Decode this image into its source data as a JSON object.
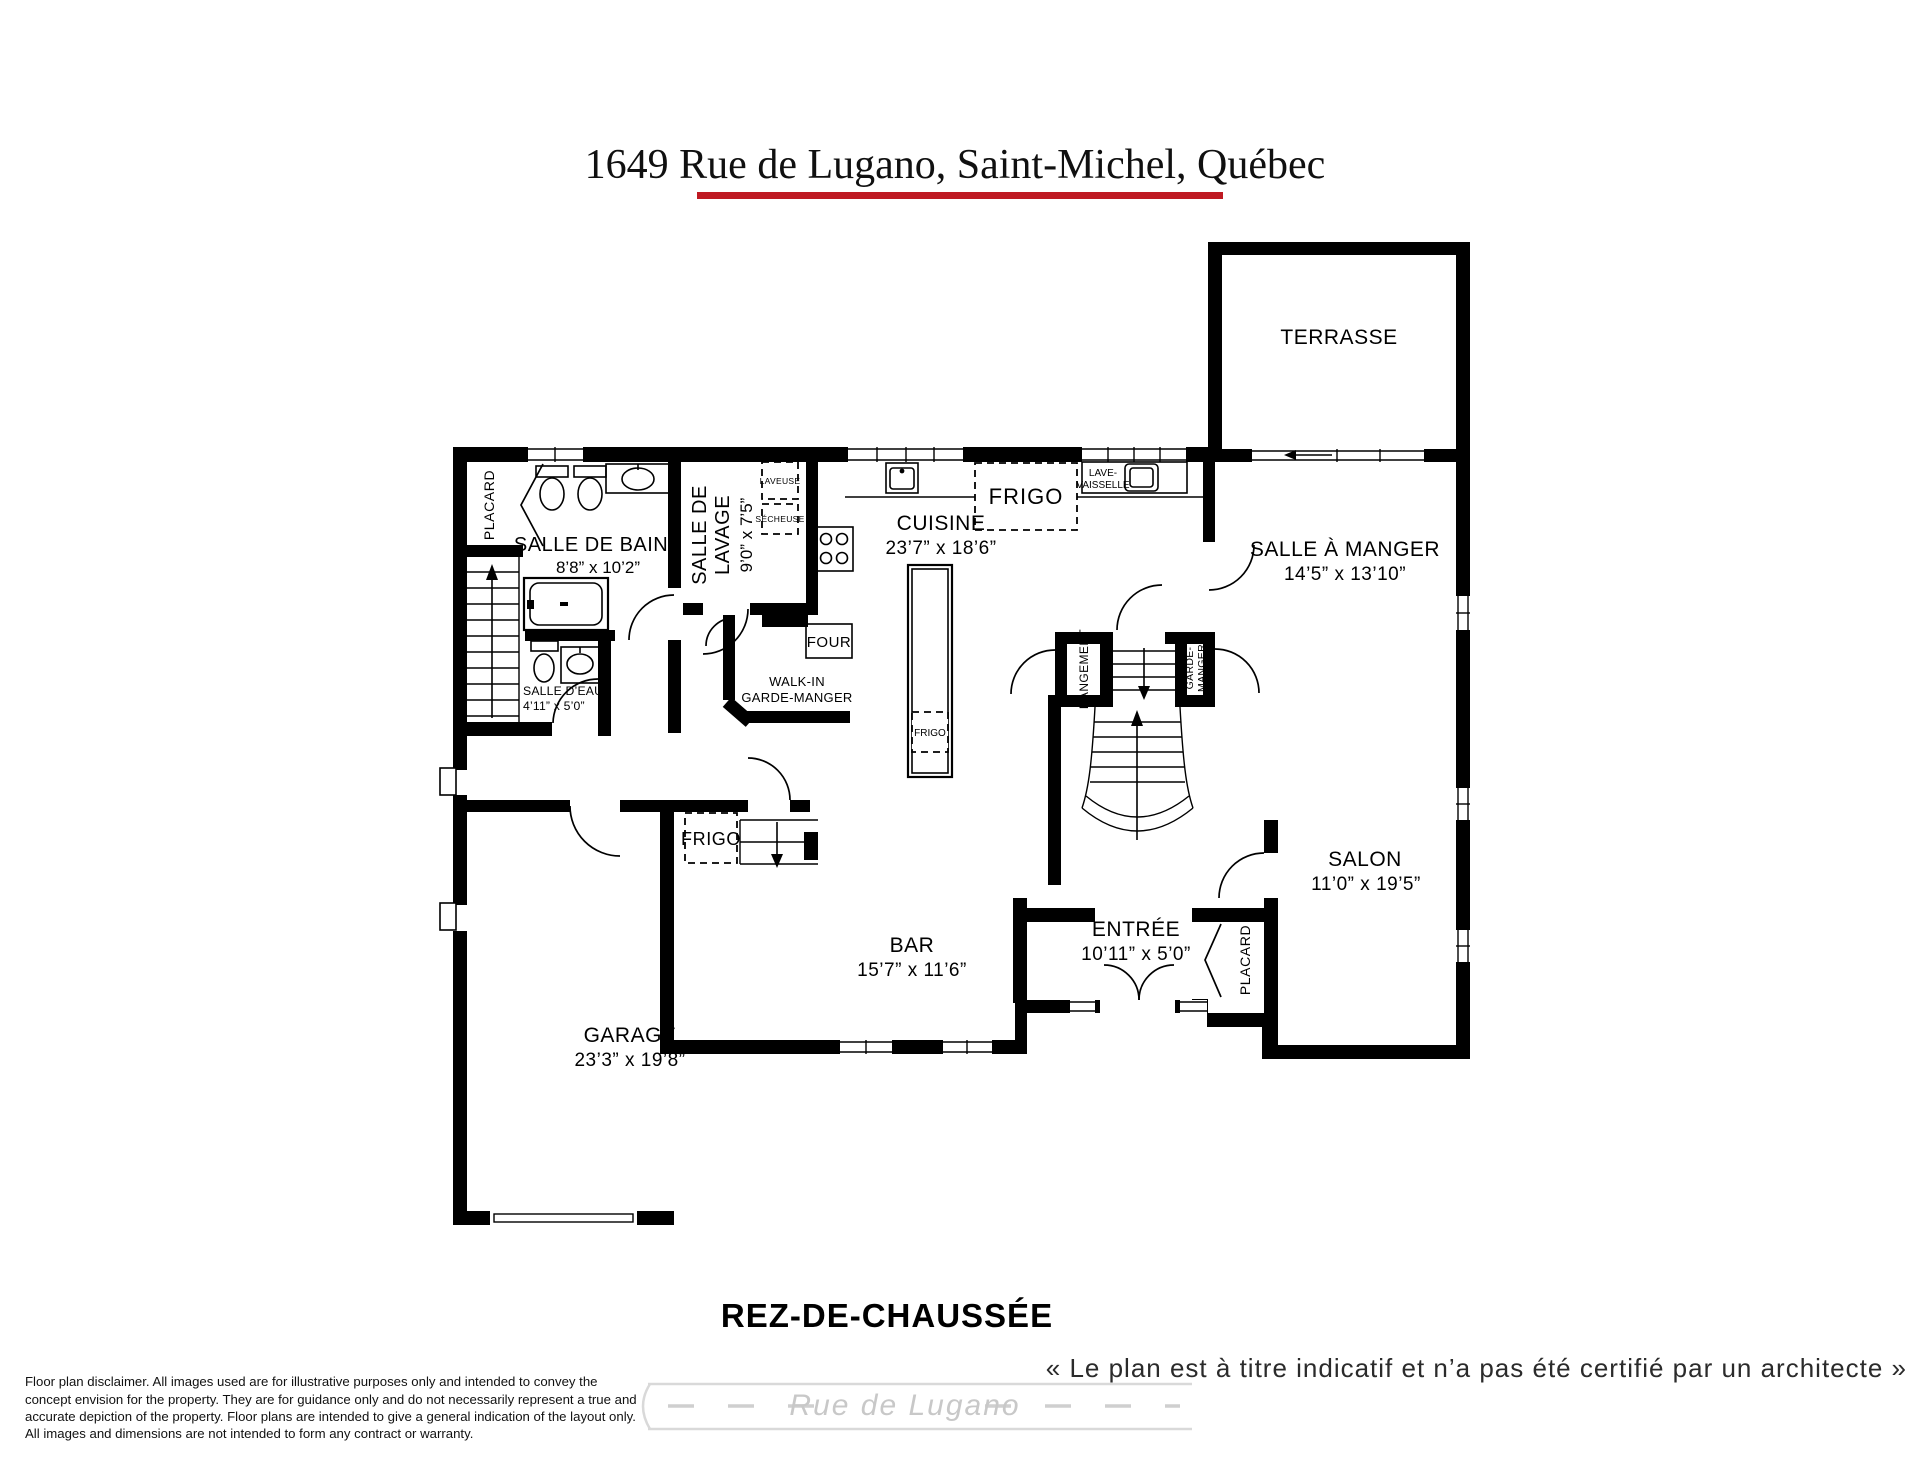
{
  "page": {
    "title": "1649 Rue de Lugano, Saint-Michel, Québec",
    "underline_color": "#bf1a22",
    "floor_label": "REZ-DE-CHAUSSÉE",
    "quote": "« Le plan est à titre indicatif et n’a pas été certifié par un architecte »",
    "street_watermark": "Rue de Lugano"
  },
  "disclaimer": {
    "lines": [
      "Floor plan disclaimer. All images used are for illustrative purposes only and intended to convey the",
      "concept envision for the property. They are for guidance only and do not necessarily represent a true and",
      "accurate depiction of the property. Floor plans are intended to give a general indication of the layout only.",
      "All images and dimensions are not intended to form any contract or warranty."
    ]
  },
  "rooms": {
    "terrasse": {
      "name": "TERRASSE"
    },
    "salle_de_bains": {
      "name": "SALLE DE BAINS",
      "dims": "8’8” x 10’2”"
    },
    "salle_de_lavage": {
      "name_line1": "SALLE DE",
      "name_line2": "LAVAGE",
      "dims": "9’0” x 7’5”"
    },
    "cuisine": {
      "name": "CUISINE",
      "dims": "23’7” x 18’6”"
    },
    "salle_a_manger": {
      "name": "SALLE À MANGER",
      "dims": "14’5” x 13’10”"
    },
    "salon": {
      "name": "SALON",
      "dims": "11’0” x 19’5”"
    },
    "bar": {
      "name": "BAR",
      "dims": "15’7” x 11’6”"
    },
    "entree": {
      "name": "ENTRÉE",
      "dims": "10’11” x 5’0”"
    },
    "garage": {
      "name": "GARAGE",
      "dims": "23’3” x 19’8”"
    },
    "salle_d_eau": {
      "name": "SALLE D’EAU",
      "dims": "4’11” x 5’0”"
    },
    "walk_in": {
      "line1": "WALK-IN",
      "line2": "GARDE-MANGER"
    }
  },
  "labels": {
    "placard_haut": "PLACARD",
    "placard_entree": "PLACARD",
    "rangement": "RANGEMENT",
    "garde_manger_line1": "GARDE-",
    "garde_manger_line2": "MANGER",
    "frigo_cuisine": "FRIGO",
    "frigo_garage": "FRIGO",
    "frigo_ilot": "FRIGO",
    "lave_vaisselle_line1": "LAVE-",
    "lave_vaisselle_line2": "VAISSELLE",
    "laveuse": "LAVEUSE",
    "secheuse": "SÉCHEUSE",
    "four": "FOUR"
  }
}
